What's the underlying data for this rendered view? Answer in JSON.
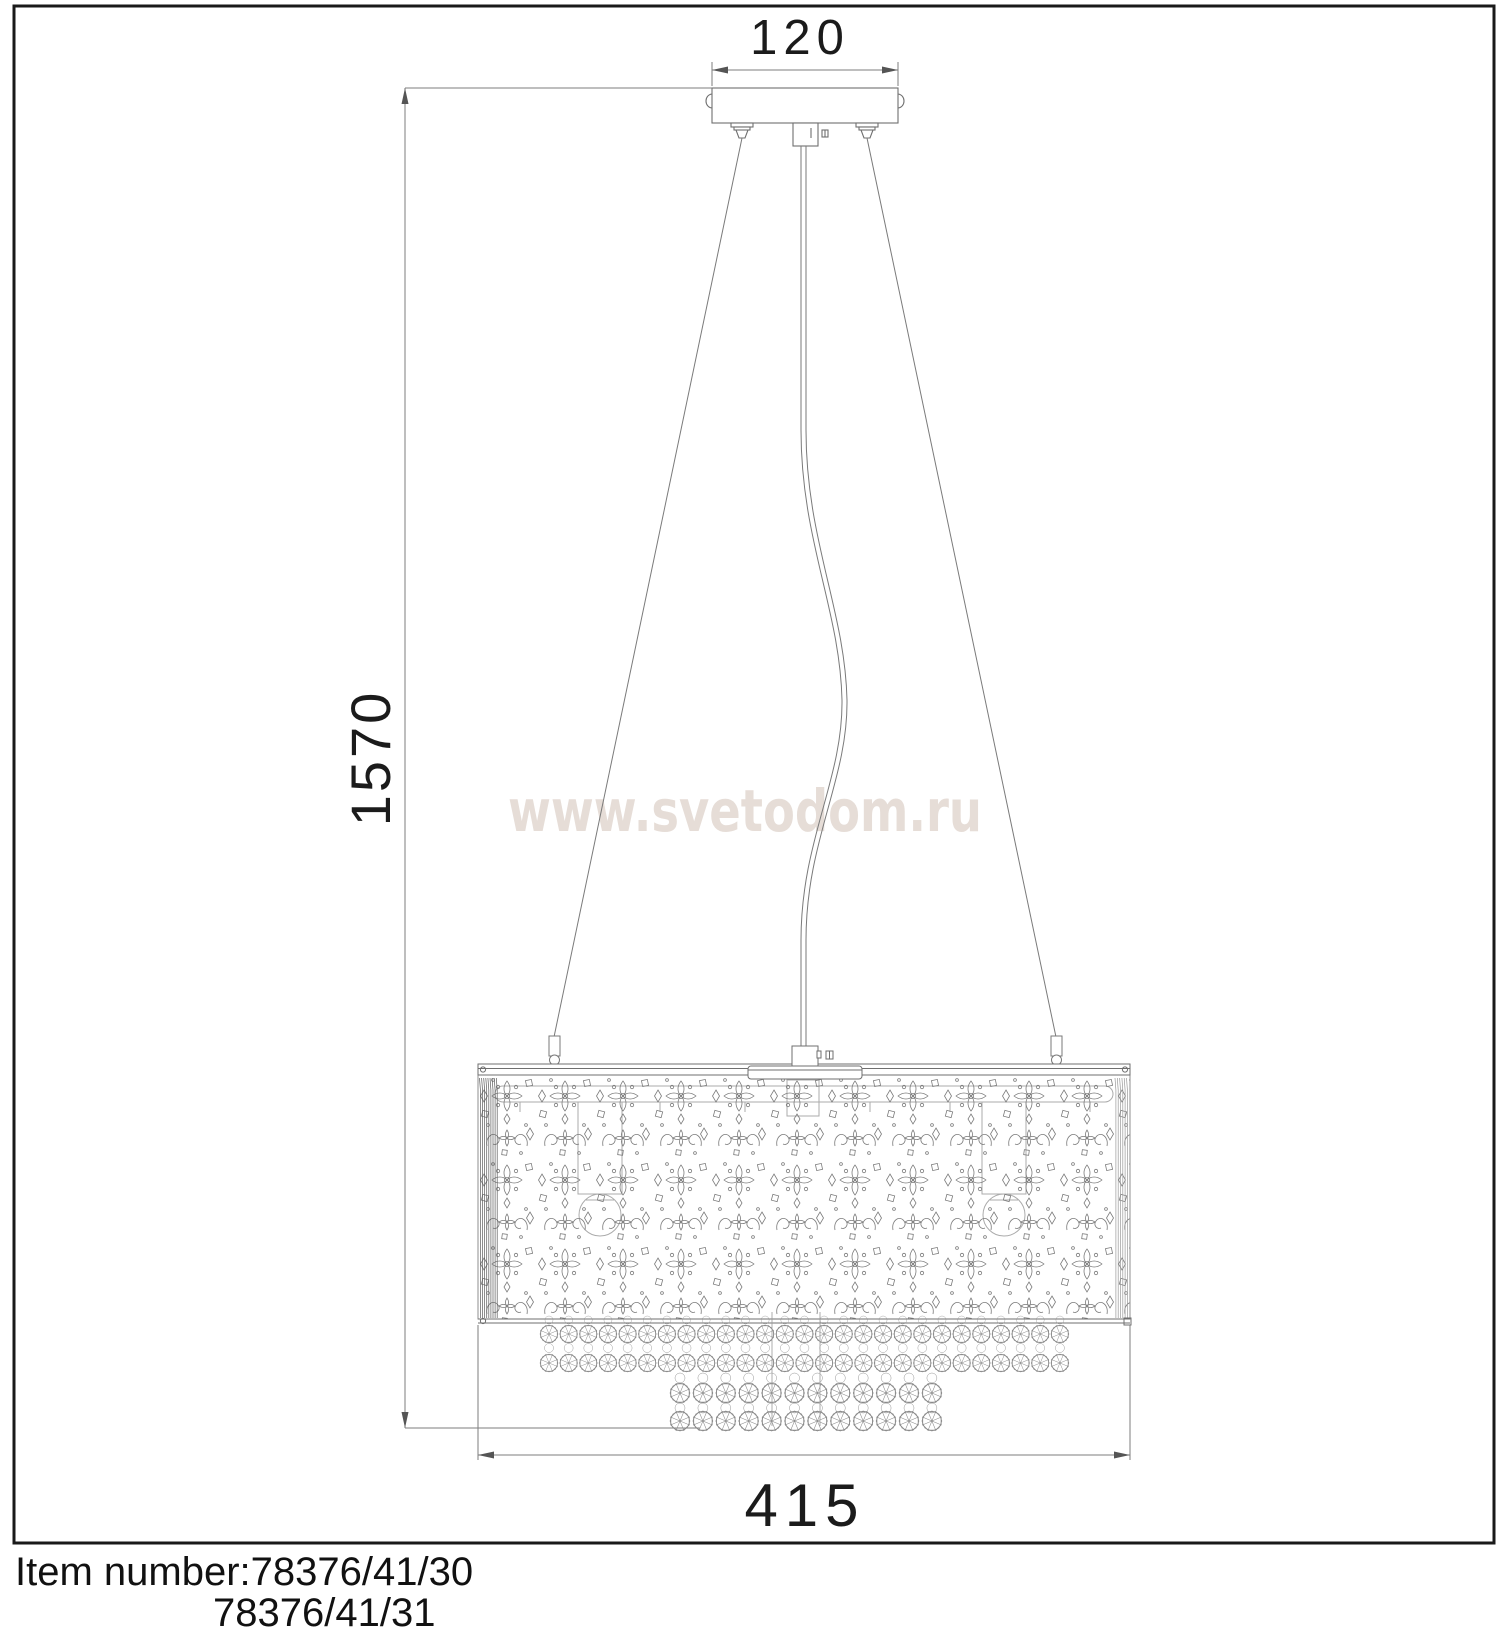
{
  "watermark": {
    "text": "www.svetodom.ru",
    "color": "#e6ddd7"
  },
  "dimensions": {
    "canopy_width": "120",
    "overall_height": "1570",
    "shade_width": "415"
  },
  "item_numbers": {
    "line1": "Item number:78376/41/30",
    "line2": "78376/41/31"
  },
  "colors": {
    "line": "#767676",
    "line_faint": "#a8a8a8",
    "bead_line": "#8a8a8a",
    "frame": "#1a1a1a",
    "text": "#1b1b1b"
  }
}
